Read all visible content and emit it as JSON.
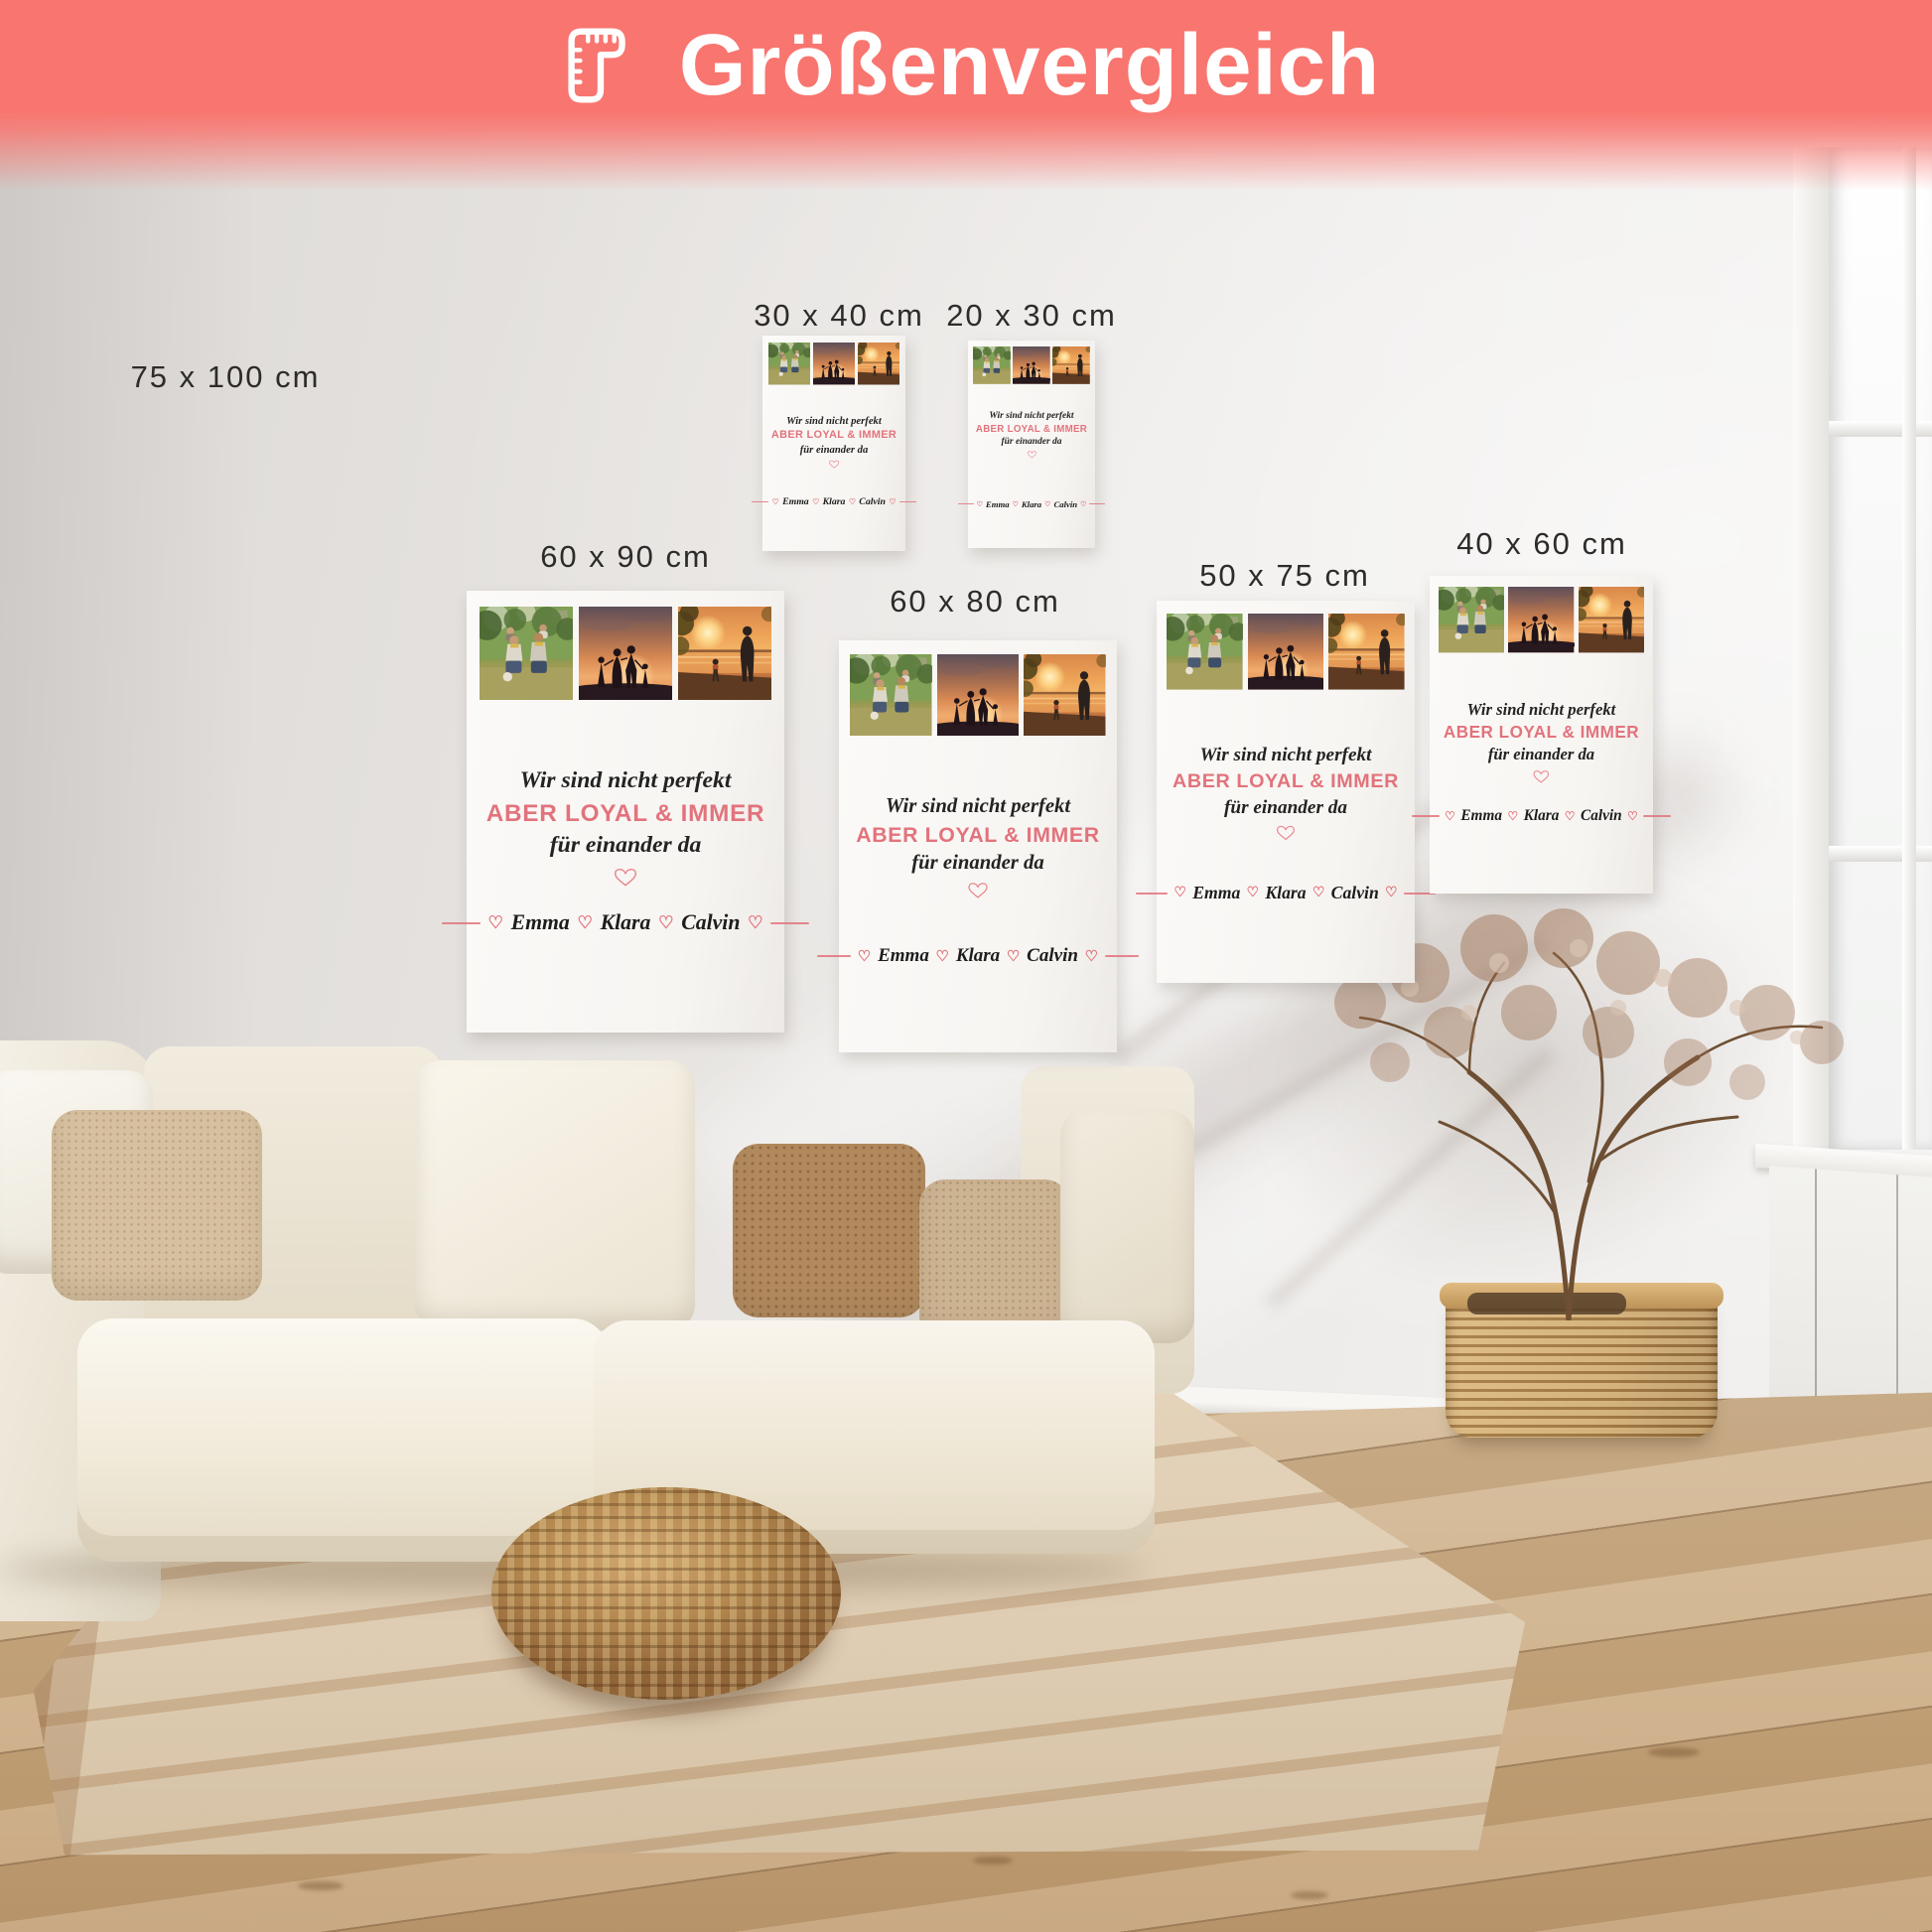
{
  "header": {
    "title": "Größenvergleich",
    "icon": "ruler-icon",
    "banner_color": "#f9756f",
    "text_color": "#ffffff"
  },
  "size_labels": {
    "s75x100": "75 x 100 cm",
    "s30x40": "30 x 40 cm",
    "s20x30": "20 x 30 cm",
    "s60x90": "60 x 90 cm",
    "s60x80": "60 x 80 cm",
    "s50x75": "50 x 75 cm",
    "s40x60": "40 x 60 cm"
  },
  "canvas_content": {
    "quote_line1": "Wir sind nicht perfekt",
    "quote_line2": "ABER LOYAL & IMMER",
    "quote_line3": "für einander da",
    "heart_symbol": "♡",
    "names": [
      "Emma",
      "Klara",
      "Calvin"
    ],
    "accent_color": "#e2737c",
    "photos": [
      "family-park-photo",
      "family-sunset-silhouette-photo",
      "father-child-sunset-photo"
    ]
  }
}
